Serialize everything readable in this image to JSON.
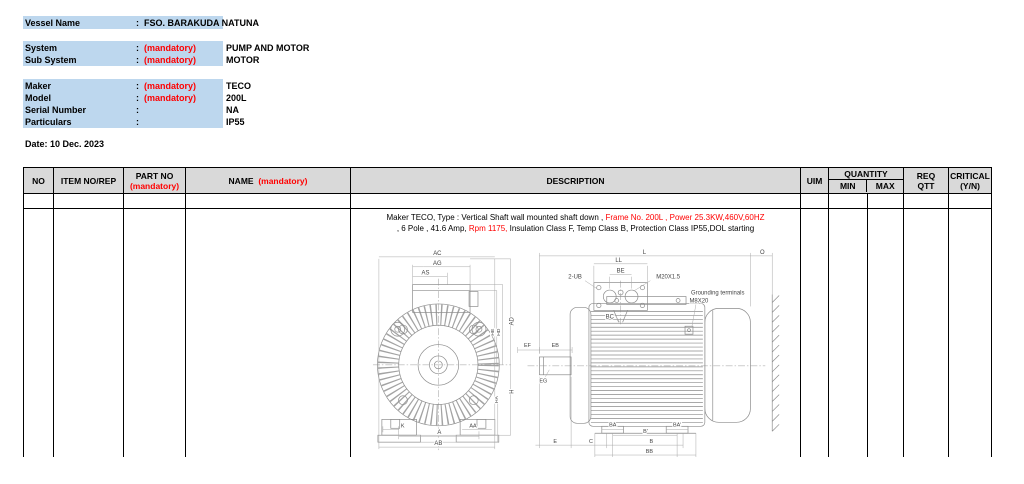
{
  "colors": {
    "highlight_blue": "#BDD7EE",
    "mandatory_red": "#FF0000",
    "table_header_gray": "#D9D9D9",
    "border_black": "#000000",
    "drawing_line_gray": "#8c8c8c"
  },
  "info": {
    "vessel_name": {
      "label": "Vessel Name",
      "colon": ":",
      "value": "FSO. BARAKUDA NATUNA"
    },
    "system": {
      "label": "System",
      "colon": ":",
      "mandatory": "(mandatory)",
      "value": "PUMP AND MOTOR"
    },
    "sub_system": {
      "label": "Sub System",
      "colon": ":",
      "mandatory": "(mandatory)",
      "value": "MOTOR"
    },
    "maker": {
      "label": "Maker",
      "colon": ":",
      "mandatory": "(mandatory)",
      "value": "TECO"
    },
    "model": {
      "label": "Model",
      "colon": ":",
      "mandatory": "(mandatory)",
      "value": "200L"
    },
    "serial_number": {
      "label": "Serial Number",
      "colon": ":",
      "mandatory": "",
      "value": "NA"
    },
    "particulars": {
      "label": "Particulars",
      "colon": ":",
      "mandatory": "",
      "value": "IP55"
    },
    "date": "Date: 10 Dec. 2023"
  },
  "table": {
    "headers": {
      "no": "NO",
      "item": "ITEM  NO/REP",
      "part_no": "PART NO",
      "part_no_note": "(mandatory)",
      "name": "NAME",
      "name_note": "(mandatory)",
      "description": "DESCRIPTION",
      "uim": "UIM",
      "quantity": "QUANTITY",
      "min": "MIN",
      "max": "MAX",
      "req_line1": "REQ",
      "req_line2": "QTT",
      "critical_line1": "CRITICAL",
      "critical_line2": "(Y/N)"
    },
    "rows": [
      {
        "no": "",
        "item": "",
        "part_no": "",
        "name": "",
        "uim": "",
        "min": "",
        "max": "",
        "req_qtt": "",
        "critical": "",
        "description_segments": [
          {
            "text": "Maker TECO, Type : Vertical Shaft wall mounted shaft down , ",
            "color": "#000000"
          },
          {
            "text": "Frame No. 200L , Power 25.3KW,460V,60HZ",
            "color": "#FF0000",
            "break_after": true
          },
          {
            "text": ", 6 Pole , 41.6 Amp,  ",
            "color": "#000000"
          },
          {
            "text": "Rpm 1175,",
            "color": "#FF0000"
          },
          {
            "text": " Insulation Class F, Temp Class B, Protection Class IP55,DOL starting",
            "color": "#000000"
          }
        ]
      }
    ]
  },
  "drawing": {
    "title": "TECO motor outline drawing - front and side views",
    "labels": [
      {
        "t": "AC",
        "x": 69,
        "y": 10
      },
      {
        "t": "AG",
        "x": 69,
        "y": 20
      },
      {
        "t": "AS",
        "x": 57,
        "y": 30
      },
      {
        "t": "AD",
        "x": 146,
        "y": 77,
        "r": -90
      },
      {
        "t": "HE",
        "x": 126,
        "y": 88,
        "r": -90,
        "s": 5
      },
      {
        "t": "HD",
        "x": 132,
        "y": 88,
        "r": -90,
        "s": 5
      },
      {
        "t": "H",
        "x": 146,
        "y": 148,
        "r": -90
      },
      {
        "t": "HA",
        "x": 130,
        "y": 156,
        "r": -90,
        "s": 5
      },
      {
        "t": "K",
        "x": 34,
        "y": 184,
        "s": 5.5
      },
      {
        "t": "AA",
        "x": 105,
        "y": 184,
        "s": 5.5
      },
      {
        "t": "A",
        "x": 71,
        "y": 191
      },
      {
        "t": "AB",
        "x": 70,
        "y": 202
      },
      {
        "t": "L",
        "x": 278,
        "y": 9
      },
      {
        "t": "O",
        "x": 397,
        "y": 9
      },
      {
        "t": "LL",
        "x": 252,
        "y": 17
      },
      {
        "t": "BE",
        "x": 254,
        "y": 28
      },
      {
        "t": "2-UB",
        "x": 208,
        "y": 34
      },
      {
        "t": "M20X1.5",
        "x": 302,
        "y": 34
      },
      {
        "t": "Grounding terminals",
        "x": 352,
        "y": 50,
        "s": 6
      },
      {
        "t": "M8X20",
        "x": 333,
        "y": 58,
        "s": 6
      },
      {
        "t": "BC",
        "x": 243,
        "y": 74
      },
      {
        "t": "EF",
        "x": 160,
        "y": 103,
        "s": 5.5
      },
      {
        "t": "EB",
        "x": 188,
        "y": 103,
        "s": 5.5
      },
      {
        "t": "EG",
        "x": 176,
        "y": 139,
        "s": 5.5
      },
      {
        "t": "BA",
        "x": 246,
        "y": 183,
        "s": 5.5
      },
      {
        "t": "BA'",
        "x": 311,
        "y": 183,
        "s": 5.5
      },
      {
        "t": "B'",
        "x": 279,
        "y": 190,
        "s": 5.5
      },
      {
        "t": "B",
        "x": 285,
        "y": 200,
        "s": 5.5
      },
      {
        "t": "BB",
        "x": 283,
        "y": 210,
        "s": 5.5
      },
      {
        "t": "C",
        "x": 224,
        "y": 200,
        "s": 5.5
      },
      {
        "t": "E",
        "x": 188,
        "y": 200,
        "s": 5.5
      }
    ]
  }
}
